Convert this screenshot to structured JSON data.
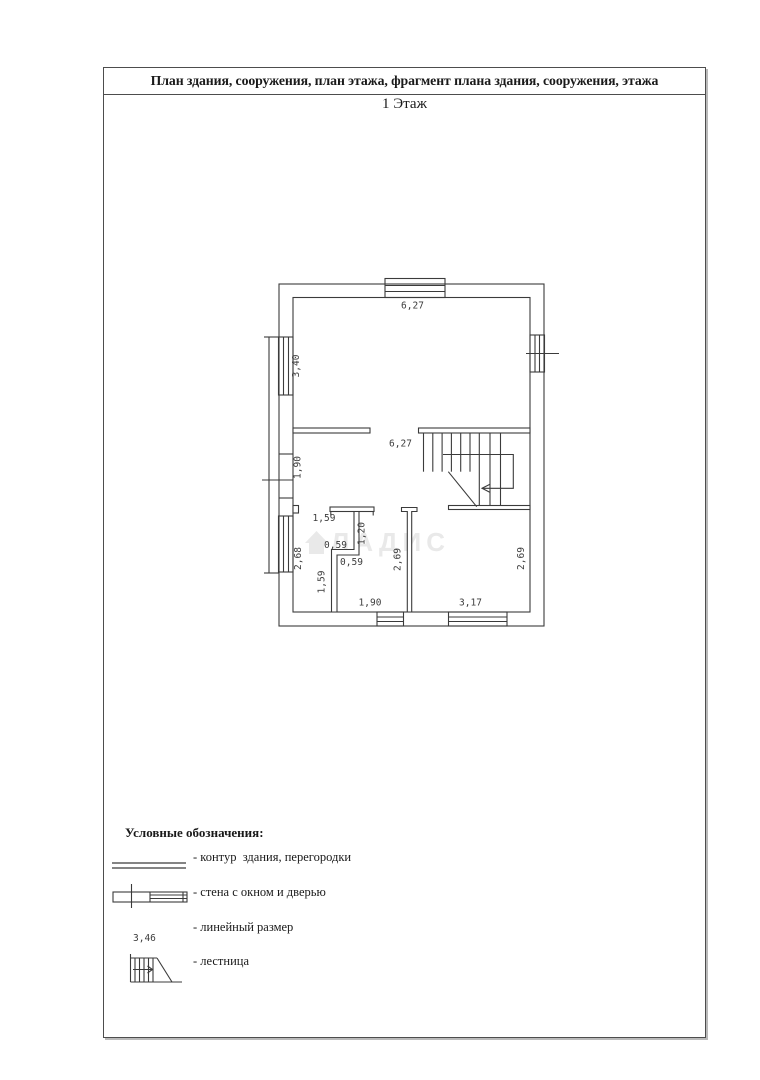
{
  "page": {
    "header_title": "План здания, сооружения, план этажа, фрагмент плана здания, сооружения, этажа",
    "floor_label": "1 Этаж"
  },
  "watermark": {
    "text": "ЛАДИС"
  },
  "plan": {
    "dims": {
      "top_width": "6,27",
      "left_window_upper": "3,40",
      "left_door": "1,90",
      "left_window_lower": "2,68",
      "hall_width": "6,27",
      "bath_top_width": "1,59",
      "bath_door_height": "1,20",
      "bath_jog_upper": "0,59",
      "bath_jog_lower": "0,59",
      "bath_left_height": "1,59",
      "room_left_height": "2,69",
      "room_right_height": "2,69",
      "bottom_left_width": "1,90",
      "bottom_right_width": "3,17"
    }
  },
  "legend": {
    "title": "Условные обозначения:",
    "items": [
      {
        "icon": "double-line-icon",
        "label": "- контур  здания, перегородки"
      },
      {
        "icon": "wall-window-door-icon",
        "label": "- стена с окном и дверью"
      },
      {
        "icon": "linear-dimension-sample",
        "label": "- линейный размер",
        "sample": "3,46"
      },
      {
        "icon": "stairs-icon",
        "label": "- лестница"
      }
    ]
  },
  "colors": {
    "line": "#3b3b3b",
    "border": "#4d4d4d",
    "watermark": "#e9e9e9"
  }
}
